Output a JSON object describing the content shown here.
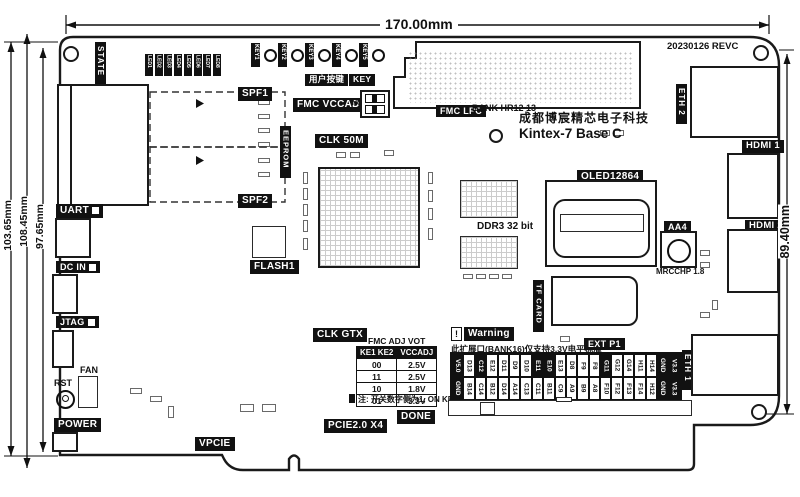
{
  "board": {
    "company": "成都博宸精芯电子科技",
    "product": "Kintex-7 Base C",
    "revision": "20230126 REVC"
  },
  "dimensions": {
    "top": "170.00mm",
    "left1": "103.65mm",
    "left2": "108.45mm",
    "left3": "97.65mm",
    "right": "89.40mm"
  },
  "top_edge": {
    "state_label": "STATE",
    "leds": [
      "LED1",
      "LED2",
      "LED3",
      "LED4",
      "LED5",
      "LED6",
      "LED7",
      "LED8"
    ],
    "keys": [
      "KEY1",
      "KEY2",
      "KEY3",
      "KEY4",
      "KEY5"
    ],
    "user_key_label": "用户按键",
    "user_key_label2": "KEY"
  },
  "left_edge": {
    "spf1": "SPF1",
    "spf2": "SPF2",
    "eeprom": "EEPROM",
    "uart": "UART",
    "dc_in": "DC IN",
    "jtag": "JTAG",
    "fan": "FAN",
    "rst": "RST",
    "power": "POWER"
  },
  "center": {
    "fmc_vccadj": "FMC VCCADJ",
    "no": "NO",
    "clk_50m": "CLK 50M",
    "clk_gtx": "CLK GTX",
    "flash": "FLASH1",
    "fmc_lpc": "FMC LPC",
    "bank": "BANK HR12 13",
    "ddr3": "DDR3 32 bit",
    "oled": "OLED12864",
    "tf_card": "TF CARD",
    "aa4": "AA4",
    "mrcchp": "MRCCHP 1.8",
    "vpcie": "VPCIE",
    "pcie": "PCIE2.0 X4",
    "done": "DONE"
  },
  "right_edge": {
    "eth1": "ETH 1",
    "eth2": "ETH 2",
    "hdmi1": "HDMI 1",
    "hdmi2": "HDMI 2"
  },
  "fmc_table": {
    "title": "FMC ADJ VOT",
    "headers": [
      "KE1 KE2",
      "VCCADJ"
    ],
    "rows": [
      [
        "00",
        "2.5V"
      ],
      [
        "11",
        "2.5V"
      ],
      [
        "10",
        "1.8V"
      ],
      [
        "01",
        "3.3V"
      ]
    ],
    "note": "注: 开关数字侧为1, ON KE侧为0"
  },
  "warning": {
    "mark": "!",
    "title": "Warning",
    "text": "此扩展口(BANK16)仅支持3.3V电平标准",
    "ext_label": "EXT P1"
  },
  "ext_header": {
    "cols": [
      {
        "t": "V5.0",
        "b": "GND",
        "tb": true,
        "bb": true
      },
      {
        "t": "D13",
        "b": "B14"
      },
      {
        "t": "C12",
        "b": "C14",
        "tb": true
      },
      {
        "t": "E12",
        "b": "B12"
      },
      {
        "t": "D11",
        "b": "D14"
      },
      {
        "t": "D9",
        "b": "A14"
      },
      {
        "t": "D10",
        "b": "C13"
      },
      {
        "t": "E11",
        "b": "C11",
        "tb": true
      },
      {
        "t": "E10",
        "b": "B11",
        "tb": true
      },
      {
        "t": "E13",
        "b": "C9"
      },
      {
        "t": "D8",
        "b": "A9"
      },
      {
        "t": "F9",
        "b": "B9"
      },
      {
        "t": "F8",
        "b": "A8"
      },
      {
        "t": "G11",
        "b": "F10",
        "tb": true
      },
      {
        "t": "G12",
        "b": "F12"
      },
      {
        "t": "G14",
        "b": "F13"
      },
      {
        "t": "H11",
        "b": "F14"
      },
      {
        "t": "H14",
        "b": "H12"
      },
      {
        "t": "GND",
        "b": "GND",
        "tb": true,
        "bb": true
      },
      {
        "t": "V3.3",
        "b": "V3.3",
        "tb": true,
        "bb": true
      }
    ]
  }
}
